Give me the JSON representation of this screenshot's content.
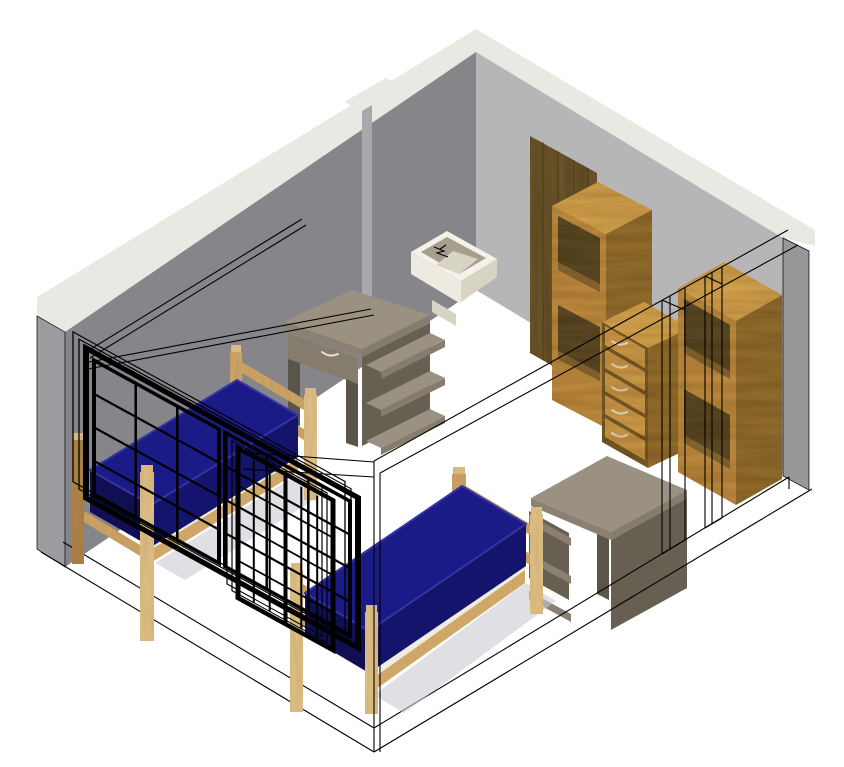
{
  "scene": {
    "title": "3D axonometric cutaway rendering of a furnished dorm bedroom",
    "view": "axonometric cutaway; two rear walls shaded, two front walls and windows drawn as black wireframe",
    "objects": [
      {
        "id": "walls",
        "label": "Gray room walls with white top band (cutaway view)"
      },
      {
        "id": "door",
        "label": "Dark wood door on back wall"
      },
      {
        "id": "sink",
        "label": "Wall-mounted sink with faucet"
      },
      {
        "id": "bookcase-left",
        "label": "Tall oak bookcase with open shelves"
      },
      {
        "id": "dresser",
        "label": "Five-drawer oak dresser with curved handles"
      },
      {
        "id": "bookcase-right",
        "label": "Tall oak wardrobe bookcase with open shelves"
      },
      {
        "id": "desk-back",
        "label": "Taupe student desk with drawer and side shelves, against back wall"
      },
      {
        "id": "desk-front",
        "label": "Taupe student desk with side shelves, near right bed"
      },
      {
        "id": "floor-outline",
        "label": "Wireframe floor outline of removed front walls"
      },
      {
        "id": "bed-left",
        "label": "Twin bed with wood frame and navy mattress (left)"
      },
      {
        "id": "bed-right",
        "label": "Twin bed with wood frame and navy mattress (right)"
      },
      {
        "id": "wall-wireframe",
        "label": "Wireframe edges of removed front walls and door-opening jambs"
      },
      {
        "id": "window-left",
        "label": "Divided-light double sash window, wireframe (left)"
      },
      {
        "id": "window-right",
        "label": "Divided-light double sash window, wireframe (right)"
      }
    ]
  },
  "colors": {
    "bg": "#ffffff",
    "wire": "#000000",
    "wall_left": "#85858a",
    "wall_back": "#b6b6b9",
    "wall_band": "#e9e9e3",
    "wall_cap": "#9c9ca0",
    "wall_right_cap": "#98989b",
    "wall_seam": "#a9a9ad",
    "mattress_top": "#1b1b88",
    "mattress_side": "#14146d",
    "mattress_dark": "#0f0f52",
    "mattress_hl": "#3434a2",
    "bed_wood": "#cfa768",
    "bed_wood_dark": "#b08648",
    "bed_wood_light": "#e0c187",
    "deck": "#efece0",
    "shadow": "#c9c9d2",
    "oak_top": "#d7a74f",
    "oak_front": "#c28f41",
    "oak_side": "#96702f",
    "oak_interior": "#5e4b26",
    "oak_shelf": "#8a6a33",
    "drawer_face": "#cf9c49",
    "drawer_gap": "#7a5c28",
    "handle": "#e9e1ce",
    "door_wood": "#6e572c",
    "door_streak": "#4f3d1d",
    "desk_top": "#9a9183",
    "desk_edge": "#8a8173",
    "desk_front": "#857c6d",
    "desk_side": "#675f52",
    "desk_leg": "#5b5448",
    "sink_rim": "#f4f2e8",
    "sink_body": "#edebdf",
    "sink_inner": "#a59f90",
    "sink_shade": "#d8d4c4"
  }
}
